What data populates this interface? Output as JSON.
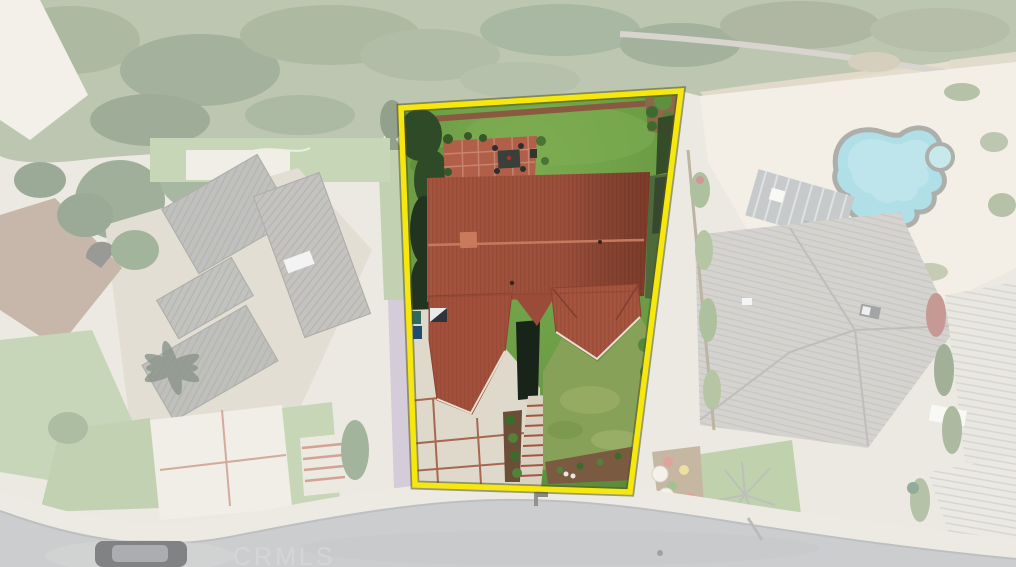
{
  "watermark": {
    "text": "CRMLS"
  },
  "scene": {
    "type": "aerial-real-estate-photo",
    "highlight": "yellow-property-boundary",
    "features": [
      "highlighted-lot",
      "tile-roof-house",
      "backyard-lawn",
      "brick-patio",
      "driveway",
      "front-lawn",
      "walkway-steps",
      "neighbor-house-left",
      "neighbor-house-right",
      "swimming-pool",
      "spa",
      "pergola",
      "street",
      "parked-car",
      "tree-belt"
    ]
  },
  "colors": {
    "boundary": "#f6e80c",
    "roof_tile": "#a5543e",
    "backyard_lawn": "#699b44",
    "front_lawn": "#88a158",
    "driveway": "#ded9cb",
    "patio_brick": "#b25f4a",
    "pool_water": "#74c6d4",
    "road": "#a4a7a9",
    "left_neighbor_roof": "#cdc4b2",
    "right_neighbor_roof": "#b3b0a9",
    "vegetation": "#8a9a74",
    "watermark_gray": "#d5d8da"
  }
}
